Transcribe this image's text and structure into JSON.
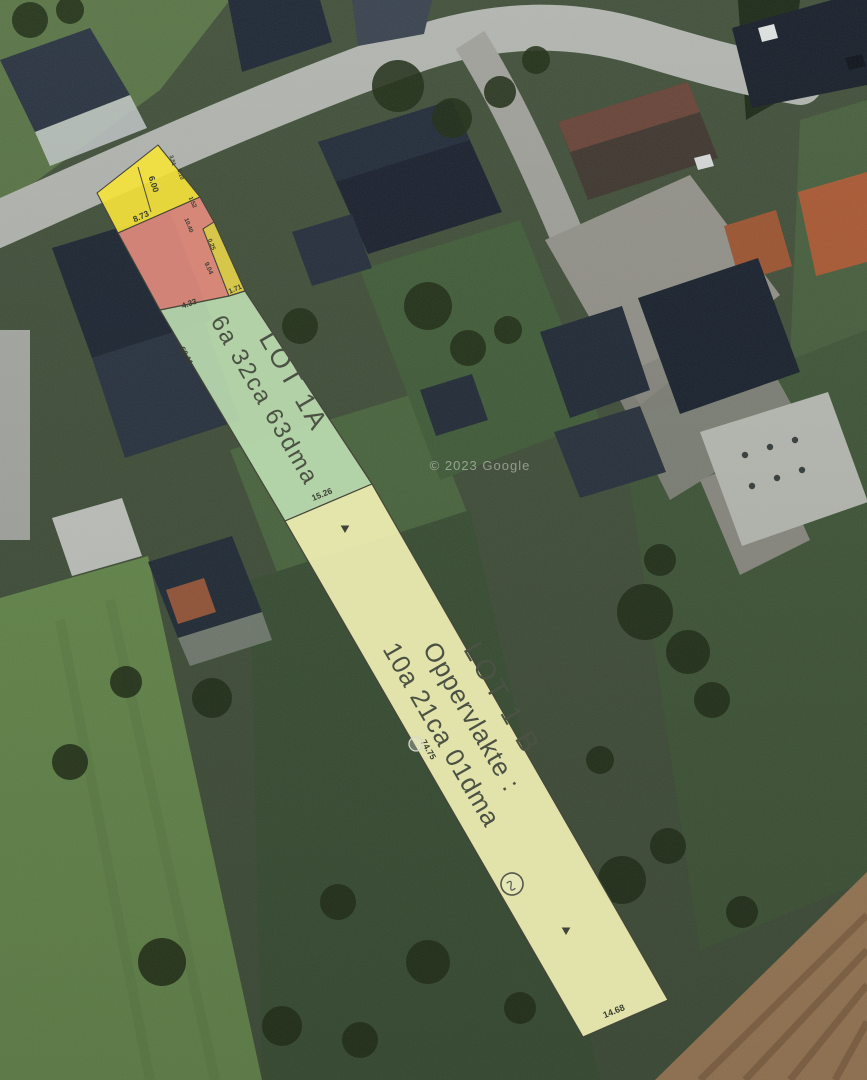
{
  "scene": {
    "description": "Aerial satellite view of a village street with a cadastral lot overlay (two building lots outlined on the photo)"
  },
  "watermark": "© 2023 Google",
  "colors": {
    "lot_top_yellow": "#f4e23b",
    "lot_red": "#e68d7e",
    "lot_wedge": "#e6d44b",
    "lot_green": "#bedfb2",
    "lot_1b": "#f0f0b4",
    "parcel_stroke": "#45453a",
    "label_text": "#4b5244"
  },
  "lot1a": {
    "title": "LOT 1A",
    "area": "6a 32ca 63dma"
  },
  "lot1b": {
    "title": "LOT 1 B",
    "area_label": "Oppervlakte :",
    "area": "10a 21ca 01dma"
  },
  "dims": {
    "top_divider": "6.00",
    "top_small_1": "3.51",
    "top_small_2": "6.10",
    "top_bottom": "8.73",
    "red_edge_1": "1.52",
    "red_edge_2": "10.40",
    "red_bottom": "4.33",
    "wedge_top": "0.25",
    "wedge_mid": "9.04",
    "wedge_bottom": "1.71",
    "green_left": "60.11",
    "green_bottom": "15.26",
    "b_left": "74.75",
    "b_bottom": "14.68"
  }
}
